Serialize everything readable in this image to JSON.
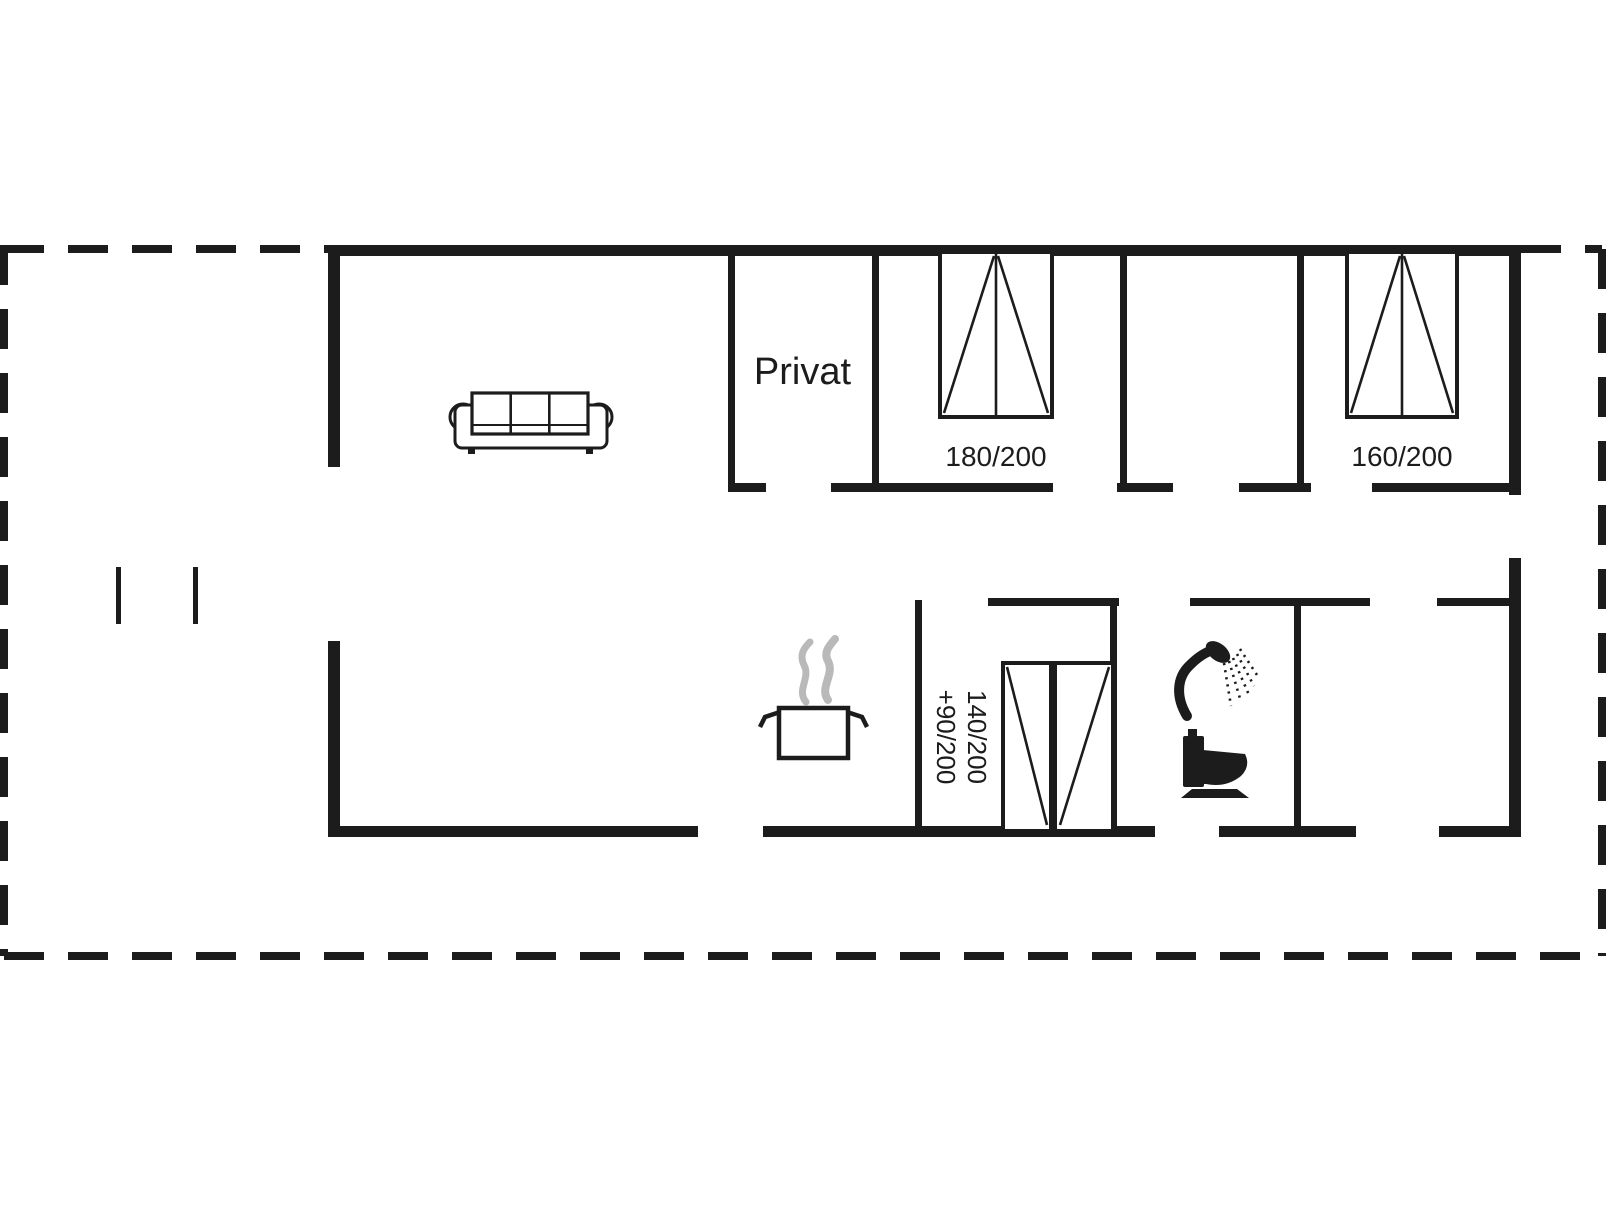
{
  "plan": {
    "type": "floor-plan",
    "background": "#ffffff",
    "wall_color": "#1c1c1c",
    "steam_color": "#b9b9b9",
    "labels": {
      "privat": "Privat",
      "bed_180": "180/200",
      "bed_160": "160/200",
      "bed_combo_line1": "140/200",
      "bed_combo_line2": "+90/200"
    },
    "icons": {
      "sofa": "sofa-icon",
      "cooking_pot": "cooking-pot-icon",
      "steam": "steam-icon",
      "shower": "shower-icon",
      "toilet": "toilet-icon",
      "bed_double_1": "double-bed-180-icon",
      "bed_double_2": "double-bed-160-icon",
      "bed_combo": "bed-140-90-icon"
    }
  }
}
